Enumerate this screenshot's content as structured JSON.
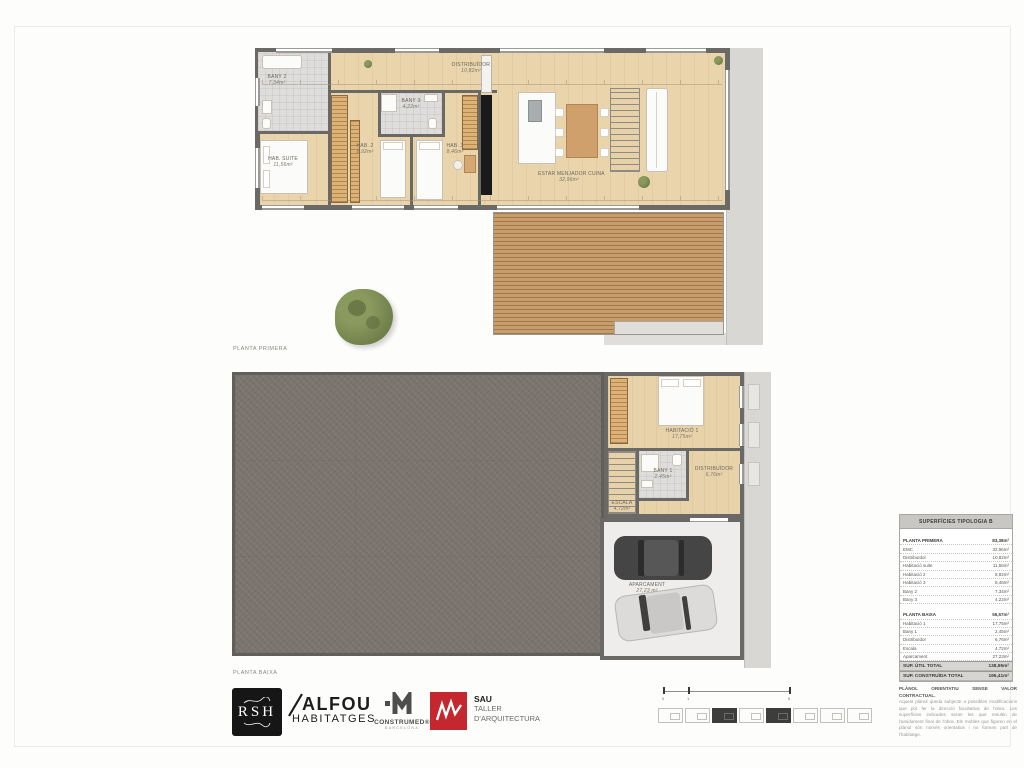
{
  "colors": {
    "wall": "#6b6966",
    "wood_floor": "#e9d4ac",
    "deck_wood": "#c79d6b",
    "ground_fill": "#7b746e",
    "paving": "#d9d7d3",
    "brand_red": "#c4272e",
    "logo_black": "#161616",
    "table_header_bg": "#c9c7c4",
    "table_total_bg": "#d7d5d2"
  },
  "plans": {
    "primera": {
      "caption": "PLANTA PRIMERA",
      "rooms": {
        "bany2": {
          "name": "BANY 2",
          "area": "7,34m²"
        },
        "suite": {
          "name": "HAB. SUITE",
          "area": "11,56m²"
        },
        "distribuidor": {
          "name": "DISTRIBUÏDOR",
          "area": "10,82m²"
        },
        "hab2": {
          "name": "HAB. 2",
          "area": "8,92m²"
        },
        "bany3": {
          "name": "BANY 3",
          "area": "4,22m²"
        },
        "hab3": {
          "name": "HAB. 3",
          "area": "8,46m²"
        },
        "estar": {
          "name": "ESTAR MENJADOR CUINA",
          "area": "32,96m²"
        }
      }
    },
    "baixa": {
      "caption": "PLANTA BAIXA",
      "rooms": {
        "hab1": {
          "name": "HABITACIÓ 1",
          "area": "17,75m²"
        },
        "bany1": {
          "name": "BANY 1",
          "area": "2,45m²"
        },
        "distribuidor": {
          "name": "DISTRIBUÏDOR",
          "area": "6,76m²"
        },
        "escala": {
          "name": "ESCALA",
          "area": "4,72m²"
        },
        "aparcament": {
          "name": "APARCAMENT",
          "area": "27,23 m²"
        }
      }
    }
  },
  "table": {
    "title": "SUPERFÍCIES TIPOLOGIA B",
    "rows": [
      {
        "label": "PLANTA PRIMERA",
        "value": "83,38m²"
      },
      {
        "label": "EMC",
        "value": "32,96m²"
      },
      {
        "label": "Distribuïdor",
        "value": "10,82m²"
      },
      {
        "label": "Habitació suite",
        "value": "11,56m²"
      },
      {
        "label": "Habitació 2",
        "value": "8,92m²"
      },
      {
        "label": "Habitació 3",
        "value": "8,46m²"
      },
      {
        "label": "Bany 2",
        "value": "7,34m²"
      },
      {
        "label": "Bany 3",
        "value": "4,22m²"
      },
      {
        "label": "PLANTA BAIXA",
        "value": "55,57m²"
      },
      {
        "label": "Habitació 1",
        "value": "17,75m²"
      },
      {
        "label": "Bany 1",
        "value": "2,45m²"
      },
      {
        "label": "Distribuïdor",
        "value": "6,76m²"
      },
      {
        "label": "Escala",
        "value": "4,72m²"
      },
      {
        "label": "Aparcament",
        "value": "27,23m²"
      }
    ],
    "totals": [
      {
        "label": "SUP. ÚTIL TOTAL",
        "value": "138,95m²"
      },
      {
        "label": "SUP. CONSTRUÏDA TOTAL",
        "value": "195,41m²"
      }
    ]
  },
  "disclaimer": {
    "title": "PLÀNOL ORIENTATIU SENSE VALOR CONTRACTUAL.",
    "body": "Aquest plànol queda subjecte a possibles modificacions que pot fer la direcció facultativa de l'obra. Les superfícies indicades seran les que resultin de l'amidament final de l'obra. Els mobles que figuren en el plànol són només orientatius i no formen part de l'habitatge."
  },
  "logos": {
    "rsh": {
      "text": "RSH"
    },
    "alfou": {
      "line1": "ALFOU",
      "line2": "HABITATGES"
    },
    "construmed": {
      "name": "CONSTRUMED®",
      "sub": "BARCELONA"
    },
    "sau": {
      "line1": "SAU",
      "line2": "TALLER",
      "line3": "D'ARQUITECTURA"
    }
  },
  "scalebar": {
    "tick0": "0",
    "tick1": "1",
    "tick2": "5"
  }
}
